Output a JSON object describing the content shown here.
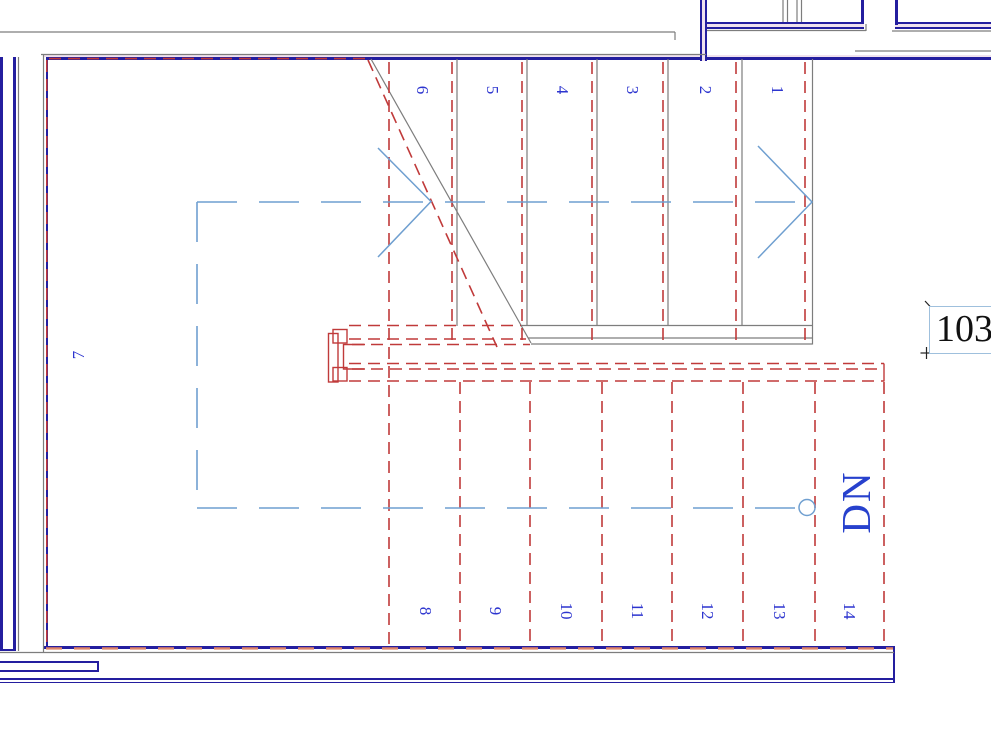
{
  "stair": {
    "upper_run_numbers": [
      "6",
      "5",
      "4",
      "3",
      "2",
      "1"
    ],
    "landing_number": "7",
    "lower_run_numbers": [
      "8",
      "9",
      "10",
      "11",
      "12",
      "13",
      "14"
    ],
    "direction_label": "DN"
  },
  "room_label": {
    "text": "103"
  },
  "colors": {
    "wall": "#241e9f",
    "line_red": "#c03a3a",
    "salmon": "#e08468",
    "line_gray": "#7d7d7d",
    "path_blue": "#6f9fd0",
    "text_blue": "#2d35cf",
    "label_border": "#9fc0dd",
    "label_text": "#111111",
    "wall_fill": "#f0e2ee"
  }
}
